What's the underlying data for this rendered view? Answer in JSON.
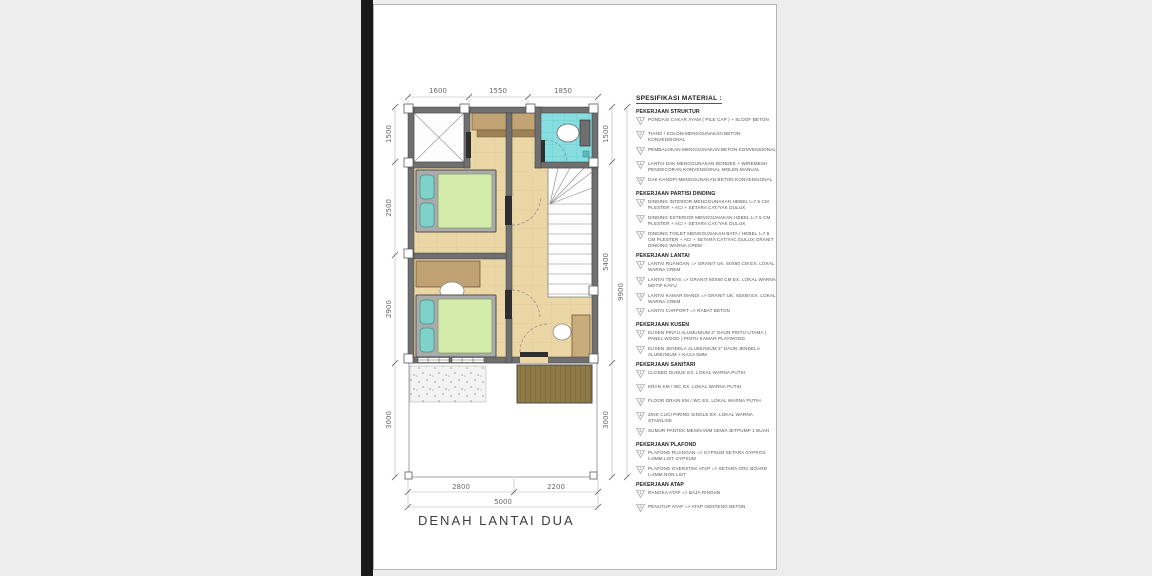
{
  "page": {
    "title": "DENAH LANTAI DUA"
  },
  "dimensions": {
    "top": [
      "1600",
      "1550",
      "1850"
    ],
    "left": [
      "1500",
      "2500",
      "2900",
      "3000"
    ],
    "right": [
      "1500",
      "5400",
      "3000"
    ],
    "right_total": "9900",
    "bottom": [
      "2800",
      "2200"
    ],
    "bottom_total": "5000"
  },
  "colors": {
    "wall": "#6f6f6f",
    "floor_tile": "#ead7a5",
    "bathroom_tile": "#87dee1",
    "mattress": "#d3ecab",
    "pillow": "#7fd2ca",
    "furniture_wood": "#bfa173",
    "deck_wood": "#8d7a45",
    "page_background": "#ffffff",
    "outer_background": "#ededed"
  },
  "spec": {
    "heading": "SPESIFIKASI MATERIAL :",
    "sections": [
      {
        "title": "PEKERJAAN STRUKTUR",
        "items": [
          {
            "n": "1",
            "text": "PONDASI CAKAR AYAM ( PILE CAP ) + SLOOF BETON"
          },
          {
            "n": "2",
            "text": "TIANG / KOLOM MENGGUNAKAN BETON KONVENSIONAL"
          },
          {
            "n": "3",
            "text": "PEMBALOKAN MENGGUNAKAN BETON KONVENSIONAL"
          },
          {
            "n": "4",
            "text": "LANTAI DAK MENGGUNAKAN BONDEK + WIREMESH PENGECORAN KONVENSIONAL MOLEN MANUAL"
          },
          {
            "n": "5",
            "text": "DAK KANOPI MENGGUNAKAN BETON KONVENSIONAL"
          }
        ]
      },
      {
        "title": "PEKERJAAN PARTISI DINDING",
        "items": [
          {
            "n": "1",
            "text": "DINDING INTERIOR MENGGUNAKAN HEBEL t=7.5 CM PLESTER + ACI + SETARA CAT/YAK DULUX"
          },
          {
            "n": "2",
            "text": "DINDING EXTERIOR MENGGUNAKAN HEBEL t=7.5 CM PLESTER + ACI + SETARA CAT/YAK DULUX"
          },
          {
            "n": "3",
            "text": "DINDING TOILET MENGGUNAKAN BATA / HEBEL t=7.5 CM PLESTER + ACI + SETARA CAT/YAC DULUX GRANIT DINDING WARNA CREM"
          }
        ]
      },
      {
        "title": "PEKERJAAN LANTAI",
        "items": [
          {
            "n": "1",
            "text": "LANTAI RUANGAN => GRANIT UK. 60X60 CM EX. LOKAL WARNA CREM"
          },
          {
            "n": "2",
            "text": "LANTAI TERAS => GRANIT 60X60 CM EX. LOKAL WARNA MOTIF KAYU"
          },
          {
            "n": "3",
            "text": "LANTAI KAMAR MANDI => GRANIT UK. 60X60 EX. LOKAL WARNA CREM"
          },
          {
            "n": "4",
            "text": "LANTAI CARPORT => RABAT BETON"
          }
        ]
      },
      {
        "title": "PEKERJAAN KUSEN",
        "items": [
          {
            "n": "1",
            "text": "KUSEN PINTU ALUMUNIUM 3\" DAUN PINTU UTAMA ( PANEL WOOD ) PINTU KAMAR PLAYWOOD"
          },
          {
            "n": "2",
            "text": "KUSEN JENDELA ALUMUNIUM 3\" DAUN JENDELA ALUMUNIUM + KACA 5MM"
          }
        ]
      },
      {
        "title": "PEKERJAAN SANITARI",
        "items": [
          {
            "n": "1",
            "text": "CLOSED DUDUK EX. LOKAL WARNA PUTIH"
          },
          {
            "n": "2",
            "text": "KRAN KM / WC EX. LOKAL WARNA PUTIH"
          },
          {
            "n": "3",
            "text": "FLOOR DRAIN KM / WC EX. LOKAL WARNA PUTIH"
          },
          {
            "n": "4",
            "text": "ZINK CUCI PIRING SINGLE EX. LOKAL WARNA STAINLISE"
          },
          {
            "n": "5",
            "text": "SUMUR PANTEK MESIN 50M SEWA JETPUMP 1 BUAH"
          }
        ]
      },
      {
        "title": "PEKERJAAN PLAFOND",
        "items": [
          {
            "n": "1",
            "text": "PLAFOND RUANGAN => GYPSUM SETARA GYPROX t=9MM LIST GYPSUM"
          },
          {
            "n": "2",
            "text": "PLAFOND OVERSTEK ATAP => SETARA GRC BOARD t=4MM NON LIST"
          }
        ]
      },
      {
        "title": "PEKERJAAN ATAP",
        "items": [
          {
            "n": "1",
            "text": "RANGKA ATAP => BAJA RINGAN"
          },
          {
            "n": "2",
            "text": "PENUTUP ATAP => ATAP GENTENG BETON"
          }
        ]
      }
    ]
  }
}
